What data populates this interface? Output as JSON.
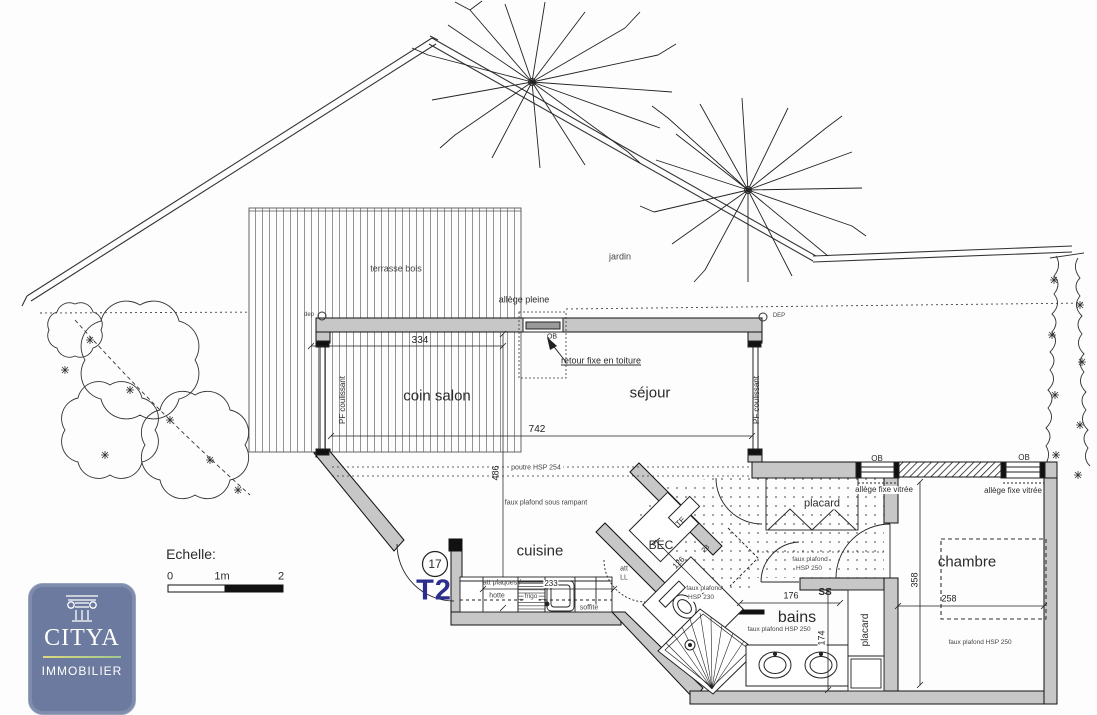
{
  "unit": {
    "number": "17",
    "type": "T2"
  },
  "scale_bar": {
    "title": "Echelle:",
    "tick_0": "0",
    "tick_1": "1m",
    "tick_2": "2"
  },
  "logo": {
    "brand": "CITYA",
    "subtitle": "IMMOBILIER"
  },
  "site": {
    "terrace": "terrasse bois",
    "garden": "jardin",
    "downspout_left": "dep",
    "downspout_right": "DEP"
  },
  "rooms": {
    "living_corner": "coin salon",
    "living": "séjour",
    "kitchen": "cuisine",
    "bath": "bains",
    "bedroom": "chambre",
    "water_heater": "BEC",
    "elec_panel": "TE",
    "entry_closet": "placard",
    "bath_closet": "placard",
    "towel_dryer": "SS"
  },
  "annotations": {
    "allege_pleine": "allège pleine",
    "ob_top": "OB",
    "retour_fixe": "retour fixe en toiture",
    "pf_coulissant_left": "PF coulissant",
    "pf_coulissant_right": "PF coulissant",
    "poutre": "poutre HSP 254",
    "faux_plafond_rampant": "faux plafond sous rampant",
    "att_plaques": "att plaques /",
    "hotte": "hotte",
    "frigo": "frigo",
    "soffite": "soffite",
    "att": "att",
    "ll": "LL",
    "wc_faux_1": "faux plafond",
    "wc_faux_2": "HSP 230",
    "hall_faux_1": "faux plafond",
    "hall_faux_2": "HSP 250",
    "bains_faux": "faux plafond HSP 250",
    "chambre_faux": "faux plafond HSP 250",
    "allege_fixe_left": "allège fixe vitrée",
    "allege_fixe_right": "allège fixe vitrée",
    "ob_left": "OB",
    "ob_right": "OB"
  },
  "dimensions": {
    "top_left": "334",
    "living_width": "742",
    "living_depth": "486",
    "kitchen_counter": "233",
    "hall_diag": "126",
    "door_diag": "23",
    "bath_width": "176",
    "bath_depth": "174",
    "bedroom_depth": "358",
    "bedroom_width": "258"
  },
  "colors": {
    "wall_fill": "#c7c7c7",
    "line": "#222222",
    "t2_blue": "#2b2e8c",
    "logo_blue": "#6b7a9e"
  }
}
